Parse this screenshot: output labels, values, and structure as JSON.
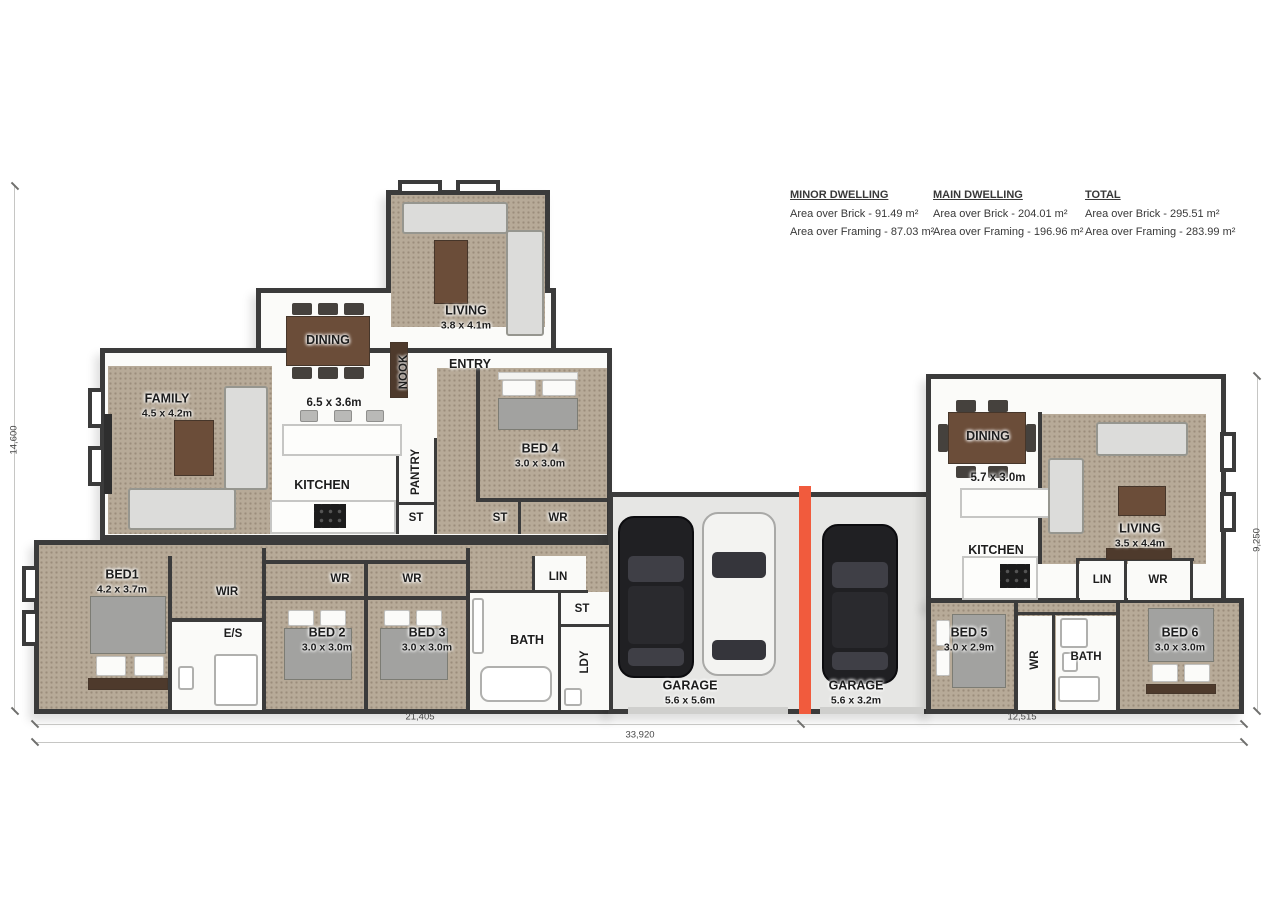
{
  "summary": {
    "minor": {
      "title": "MINOR DWELLING",
      "line1": "Area over Brick - 91.49 m²",
      "line2": "Area over Framing - 87.03 m²"
    },
    "main": {
      "title": "MAIN DWELLING",
      "line1": "Area over Brick - 204.01 m²",
      "line2": "Area over Framing - 196.96 m²"
    },
    "total": {
      "title": "TOTAL",
      "line1": "Area over Brick - 295.51 m²",
      "line2": "Area over Framing - 283.99 m²"
    }
  },
  "rooms": {
    "living_top": {
      "label": "LIVING",
      "dims": "3.8 x 4.1m"
    },
    "entry": {
      "label": "ENTRY"
    },
    "dining_main": {
      "label": "DINING"
    },
    "nook": {
      "label": "NOOK"
    },
    "kitchen_dining_dims": {
      "label": "6.5 x 3.6m"
    },
    "family": {
      "label": "FAMILY",
      "dims": "4.5 x 4.2m"
    },
    "kitchen_main": {
      "label": "KITCHEN"
    },
    "pantry": {
      "label": "PANTRY"
    },
    "st_pantry": {
      "label": "ST"
    },
    "bed4": {
      "label": "BED 4",
      "dims": "3.0 x 3.0m"
    },
    "st_hall": {
      "label": "ST"
    },
    "wr_hall": {
      "label": "WR"
    },
    "bed1": {
      "label": "BED1",
      "dims": "4.2 x 3.7m"
    },
    "wir": {
      "label": "WIR"
    },
    "ensuite": {
      "label": "E/S"
    },
    "wr_bed2": {
      "label": "WR"
    },
    "bed2": {
      "label": "BED 2",
      "dims": "3.0 x 3.0m"
    },
    "wr_bed3": {
      "label": "WR"
    },
    "bed3": {
      "label": "BED 3",
      "dims": "3.0 x 3.0m"
    },
    "bath_main": {
      "label": "BATH"
    },
    "lin_main": {
      "label": "LIN"
    },
    "st_lin": {
      "label": "ST"
    },
    "ldy": {
      "label": "LDY"
    },
    "garage_main": {
      "label": "GARAGE",
      "dims": "5.6 x 5.6m"
    },
    "garage_minor": {
      "label": "GARAGE",
      "dims": "5.6 x 3.2m"
    },
    "dining_minor": {
      "label": "DINING",
      "dims": "5.7 x 3.0m"
    },
    "kitchen_minor": {
      "label": "KITCHEN"
    },
    "living_minor": {
      "label": "LIVING",
      "dims": "3.5 x 4.4m"
    },
    "lin_minor": {
      "label": "LIN"
    },
    "wr_living": {
      "label": "WR"
    },
    "bed5": {
      "label": "BED 5",
      "dims": "3.0 x 2.9m"
    },
    "wr_bed6": {
      "label": "WR"
    },
    "bath_minor": {
      "label": "BATH"
    },
    "bed6": {
      "label": "BED 6",
      "dims": "3.0 x 3.0m"
    }
  },
  "dimensions": {
    "left_height": "14,600",
    "right_height": "9,250",
    "bottom_main": "21,405",
    "bottom_minor": "12,515",
    "bottom_total": "33,920"
  },
  "colors": {
    "wall": "#3b3b3b",
    "carpet": "#b7aa98",
    "dwelling_divider": "#f15b3d",
    "garage_floor": "#e6e6e4"
  }
}
